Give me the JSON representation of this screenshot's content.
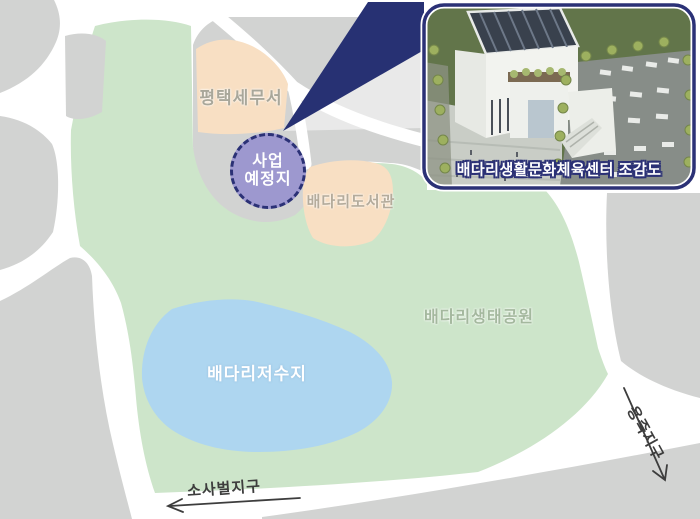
{
  "map": {
    "labels": {
      "tax_office": "평택세무서",
      "library": "배다리도서관",
      "park": "배다리생태공원",
      "reservoir": "배다리저수지",
      "site_line1": "사업",
      "site_line2": "예정지",
      "district_sw": "소사벌지구",
      "district_se": "용죽지구"
    },
    "colors": {
      "park_green": "#cde5ca",
      "lake_blue": "#aed6f0",
      "block_gray": "#d2d3d2",
      "building_beige": "#f8dfc3",
      "site_purple": "#9d98cf",
      "accent_navy": "#2b3176",
      "road_white": "#ffffff"
    }
  },
  "inset": {
    "caption": "배다리생활문화체육센터 조감도"
  }
}
